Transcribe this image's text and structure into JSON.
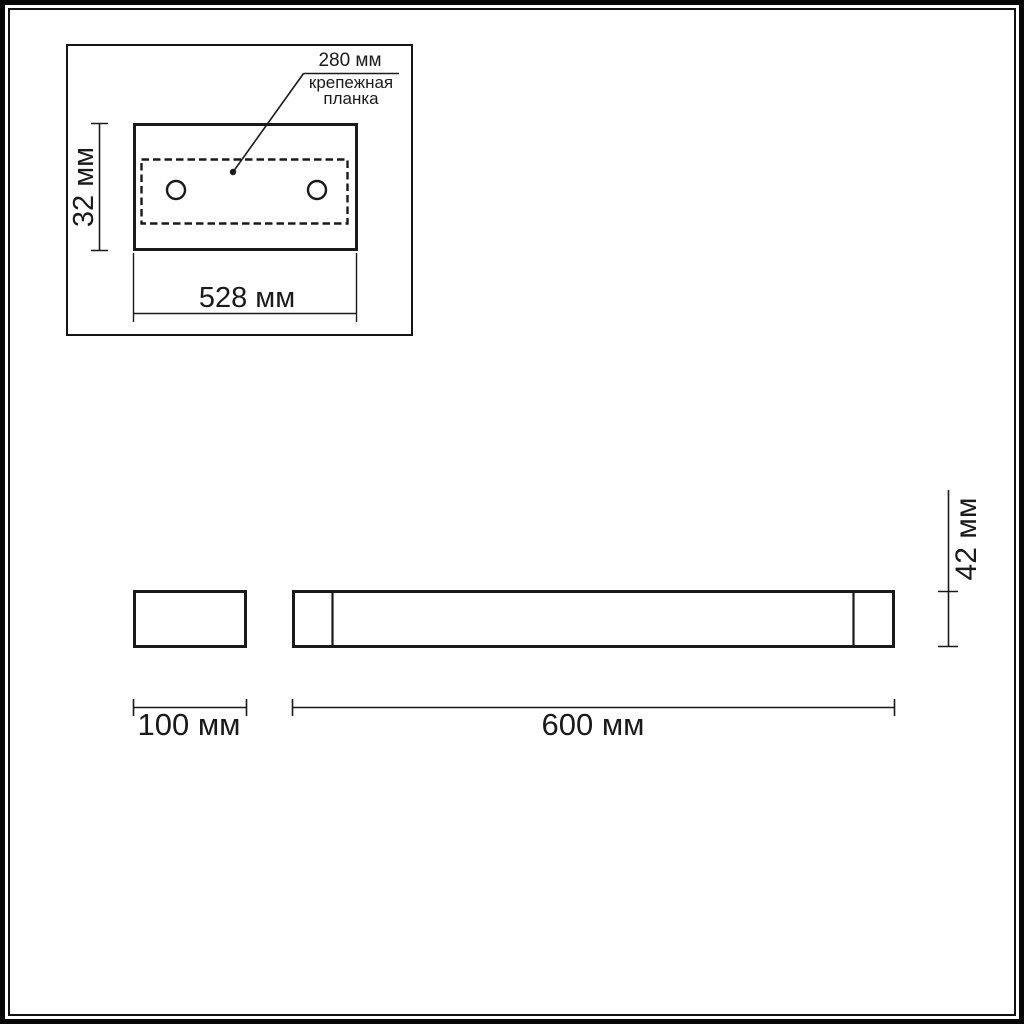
{
  "page": {
    "background_color": "#ffffff",
    "line_color": "#1a1a1a"
  },
  "top_view": {
    "callout": {
      "value": "280 мм",
      "label_line1": "крепежная",
      "label_line2": "планка"
    },
    "height_dim": "32 мм",
    "width_dim": "528 мм"
  },
  "side_view": {
    "depth_dim": "100 мм",
    "length_dim": "600 мм",
    "height_dim": "42 мм"
  }
}
